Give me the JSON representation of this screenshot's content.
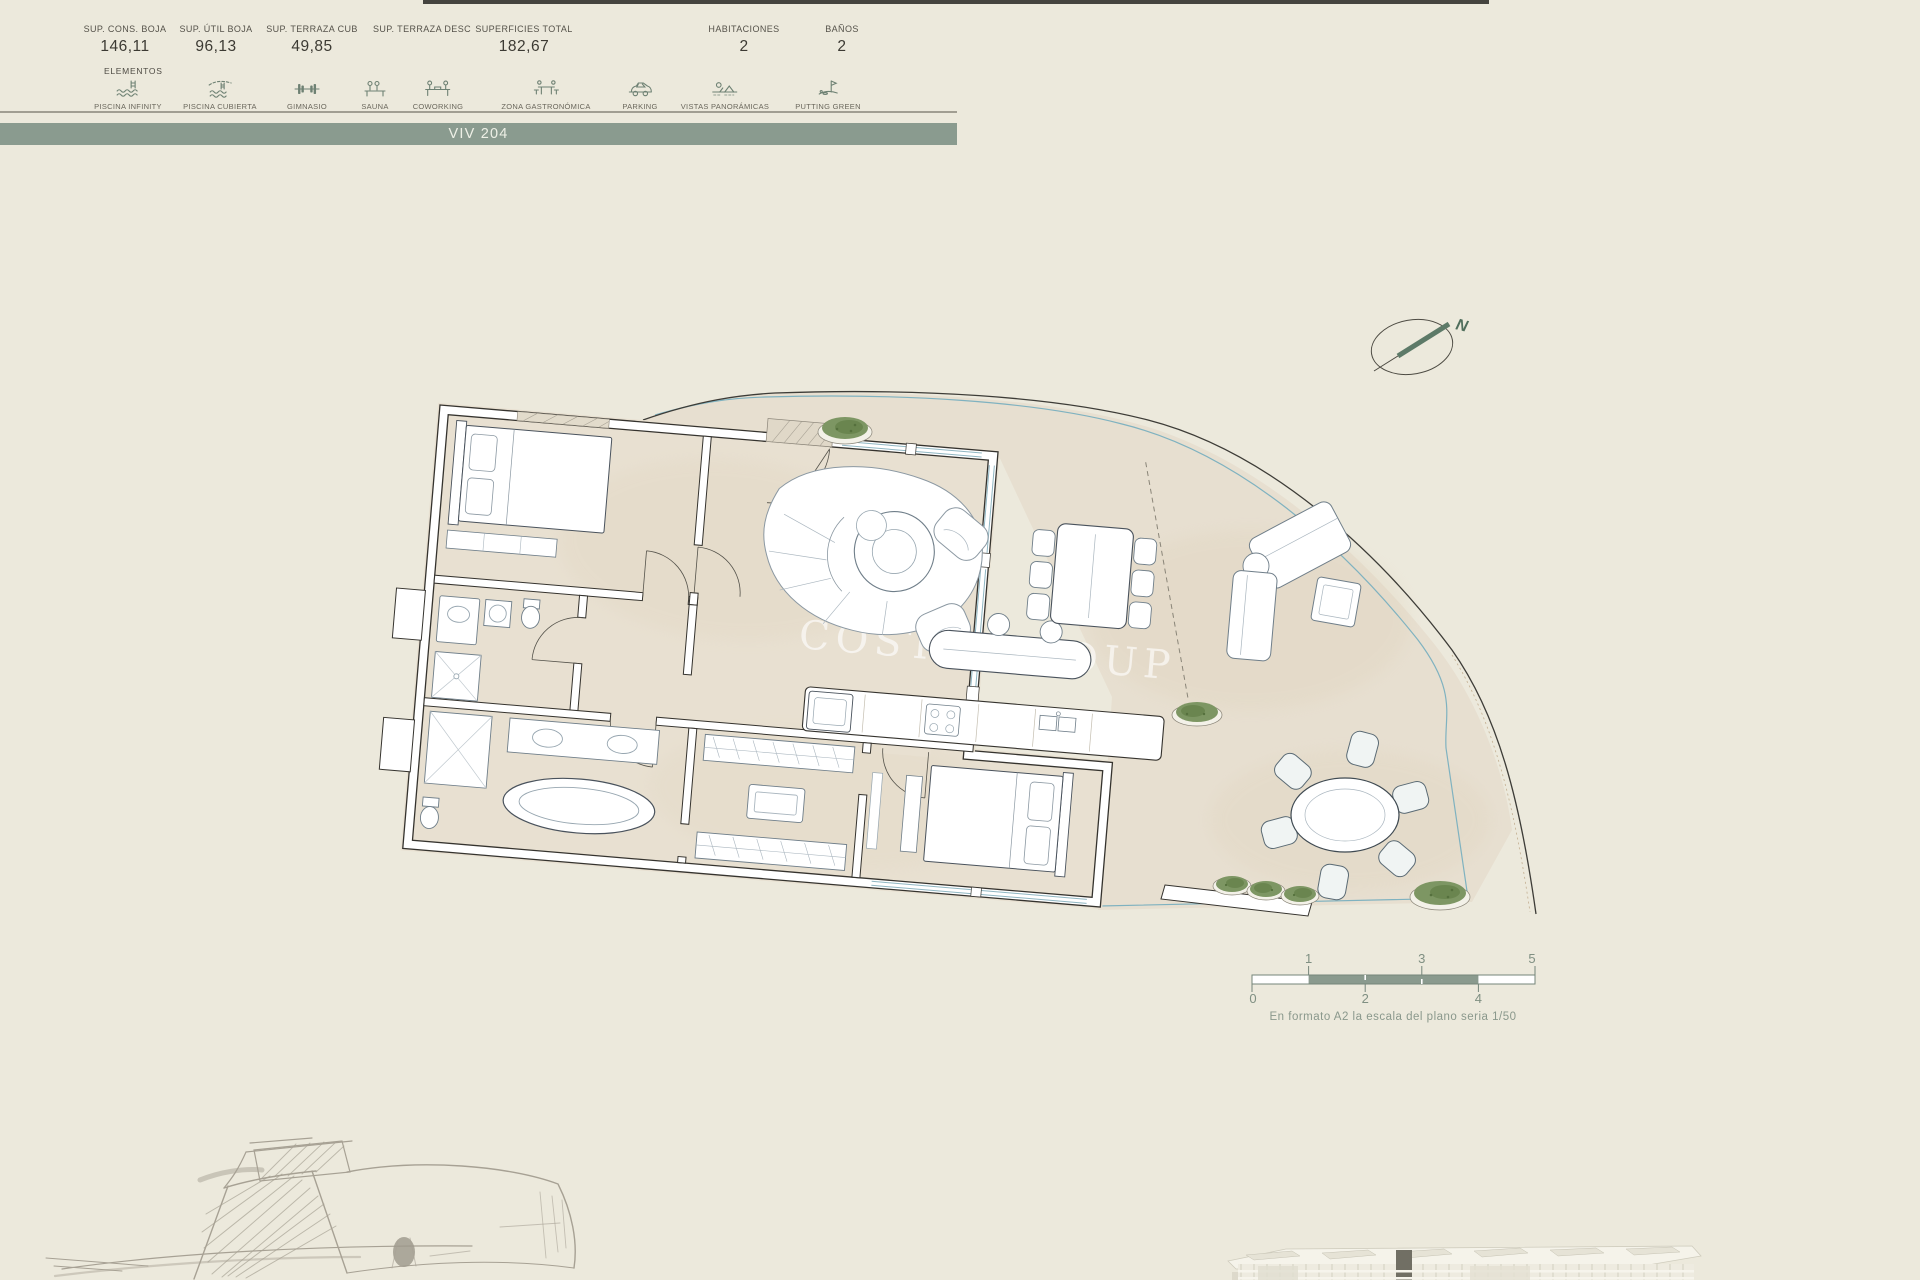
{
  "header": {
    "stats": [
      {
        "label": "SUP. CONS. BOJA",
        "value": "146,11"
      },
      {
        "label": "SUP. ÚTIL BOJA",
        "value": "96,13"
      },
      {
        "label": "SUP. TERRAZA CUB",
        "value": "49,85"
      },
      {
        "label": "SUP. TERRAZA DESC",
        "value": ""
      },
      {
        "label": "SUPERFICIES TOTAL",
        "value": "182,67"
      },
      {
        "label": "HABITACIONES",
        "value": "2"
      },
      {
        "label": "BAÑOS",
        "value": "2"
      }
    ],
    "elements_title": "ELEMENTOS",
    "elements": [
      {
        "label": "PISCINA INFINITY",
        "icon": "infinity-pool-icon"
      },
      {
        "label": "PISCINA CUBIERTA",
        "icon": "indoor-pool-icon"
      },
      {
        "label": "GIMNASIO",
        "icon": "gym-icon"
      },
      {
        "label": "SAUNA",
        "icon": "sauna-icon"
      },
      {
        "label": "COWORKING",
        "icon": "coworking-icon"
      },
      {
        "label": "ZONA GASTRONÓMICA",
        "icon": "dining-icon"
      },
      {
        "label": "PARKING",
        "icon": "parking-icon"
      },
      {
        "label": "VISTAS PANORÁMICAS",
        "icon": "views-icon"
      },
      {
        "label": "PUTTING GREEN",
        "icon": "putting-green-icon"
      }
    ]
  },
  "unit_bar": {
    "label": "VIV 204"
  },
  "plan": {
    "watermark": "COSTA GROUP",
    "compass_label": "N"
  },
  "scale_bar": {
    "top_labels": [
      "1",
      "3",
      "5"
    ],
    "bottom_labels": [
      "0",
      "2",
      "4"
    ],
    "caption": "En  formato A2 la escala del plano seria 1/50"
  },
  "theme": {
    "background": "#ece9dc",
    "bar_green": "#8a9b8f",
    "icon_green": "#6e8173",
    "floor": "#e8e0d1",
    "scale_green": "#8a9a8e",
    "boundary_blue": "#7fb2c0",
    "wall_stroke": "#35332e"
  }
}
